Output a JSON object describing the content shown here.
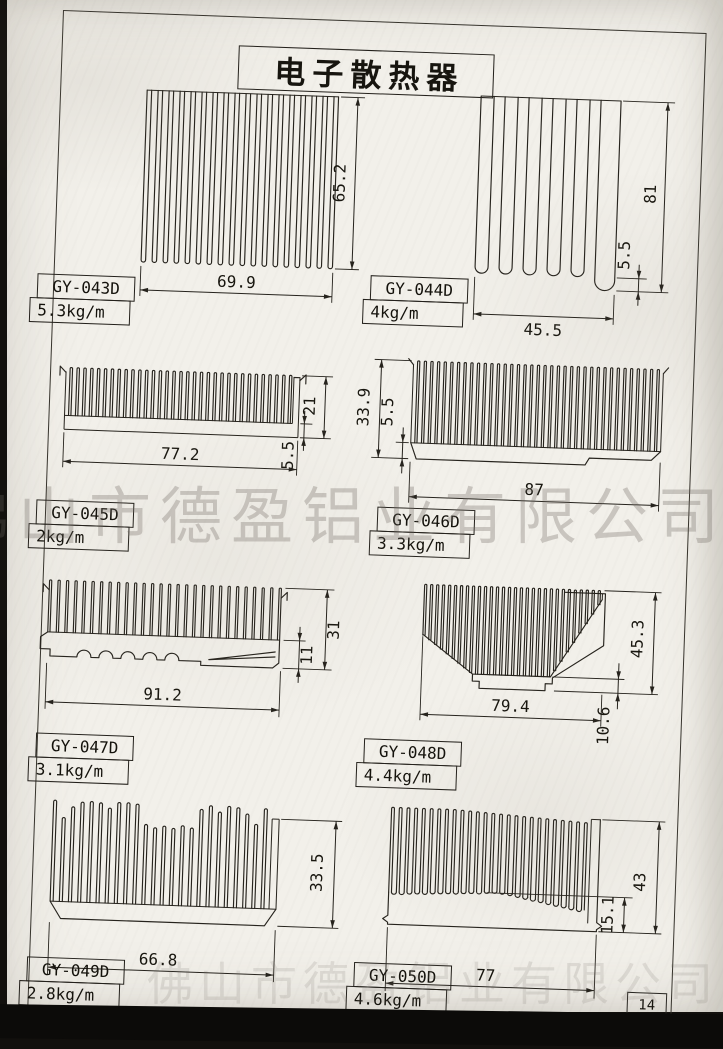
{
  "page": {
    "title": "电子散热器",
    "watermark": "佛山市德盈铝业有限公司",
    "page_number": "14"
  },
  "products": [
    {
      "model": "GY-043D",
      "weight": "5.3kg/m",
      "dim_w": "69.9",
      "dim_h": "65.2"
    },
    {
      "model": "GY-044D",
      "weight": "4kg/m",
      "dim_w": "45.5",
      "dim_h": "81",
      "dim_t": "5.5"
    },
    {
      "model": "GY-045D",
      "weight": "2kg/m",
      "dim_w": "77.2",
      "dim_h": "21",
      "dim_t": "5.5"
    },
    {
      "model": "GY-046D",
      "weight": "3.3kg/m",
      "dim_w": "87",
      "dim_h": "33.9",
      "dim_t": "5.5"
    },
    {
      "model": "GY-047D",
      "weight": "3.1kg/m",
      "dim_w": "91.2",
      "dim_h": "31",
      "dim_t": "11"
    },
    {
      "model": "GY-048D",
      "weight": "4.4kg/m",
      "dim_w": "79.4",
      "dim_h": "45.3",
      "dim_t": "10.6"
    },
    {
      "model": "GY-049D",
      "weight": "2.8kg/m",
      "dim_w": "66.8",
      "dim_h": "33.5"
    },
    {
      "model": "GY-050D",
      "weight": "4.6kg/m",
      "dim_w": "77",
      "dim_h": "43",
      "dim_t": "15.1"
    }
  ]
}
